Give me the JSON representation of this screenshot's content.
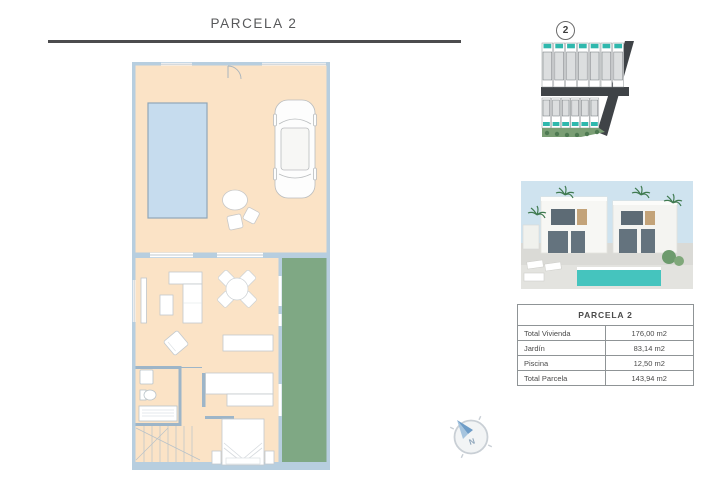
{
  "page": {
    "title": "PARCELA 2"
  },
  "site_plan": {
    "badge_number": "2"
  },
  "area_table": {
    "header": "PARCELA 2",
    "rows": [
      {
        "label": "Total Vivienda",
        "value": "176,00 m2"
      },
      {
        "label": "Jardín",
        "value": "83,14 m2"
      },
      {
        "label": "Piscina",
        "value": "12,50 m2"
      },
      {
        "label": "Total Parcela",
        "value": "143,94 m2"
      }
    ]
  },
  "compass": {
    "north_label": "N"
  },
  "colors": {
    "terrace": "#fbe3c6",
    "pool": "#c6dcee",
    "garden": "#7fa884",
    "wall": "#b7cedf",
    "render_pool": "#45c4be",
    "road": "#3f4347",
    "title_text": "#57585a",
    "table_border": "#8f9496"
  }
}
